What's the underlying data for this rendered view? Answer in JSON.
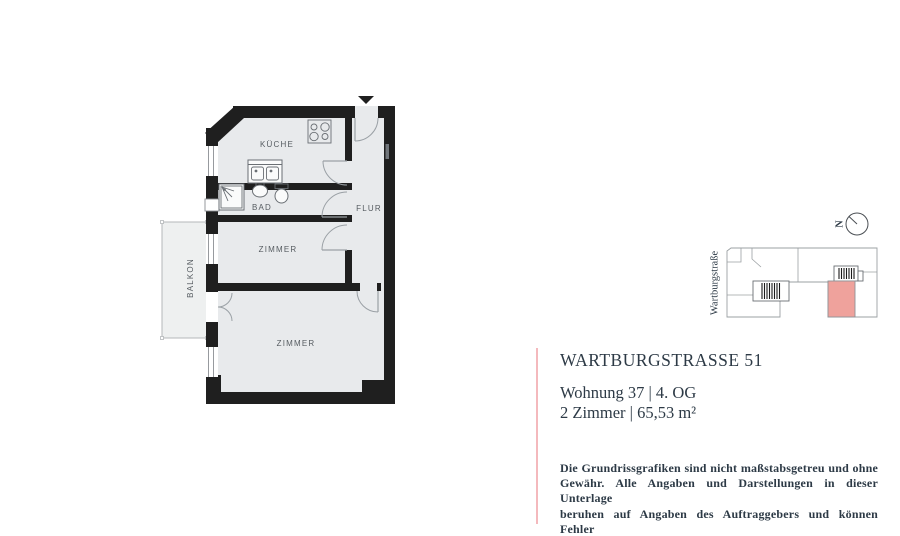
{
  "theme": {
    "accent": "#f4b9bd",
    "unit": "#efa29c",
    "wall": "#1f1f1f",
    "floor": "#e8eaec",
    "balcony": "#eef0f0",
    "ink": "#2d3a46",
    "label": "#565c61",
    "line": "#9aa0a5"
  },
  "floorplan": {
    "rooms": [
      {
        "label": "KÜCHE"
      },
      {
        "label": "BAD"
      },
      {
        "label": "FLUR"
      },
      {
        "label": "ZIMMER"
      },
      {
        "label": "ZIMMER"
      },
      {
        "label": "BALKON"
      }
    ]
  },
  "siteplan": {
    "street_label": "Wartburgstraße",
    "north_label": "N"
  },
  "info": {
    "title": "WARTBURGSTRASSE 51",
    "unit_line": "Wohnung 37 | 4. OG",
    "size_line": "2 Zimmer | 65,53 m²"
  },
  "disclaimer": {
    "lines": [
      "Die Grundrissgrafiken sind nicht maßstabsgetreu und ohne",
      "Gewähr. Alle Angaben und Darstellungen in dieser Unterlage",
      "beruhen auf Angaben des Auftraggebers und können Fehler",
      "enthalten, sodass jegliche Haftung ausgeschlossen wird."
    ]
  }
}
